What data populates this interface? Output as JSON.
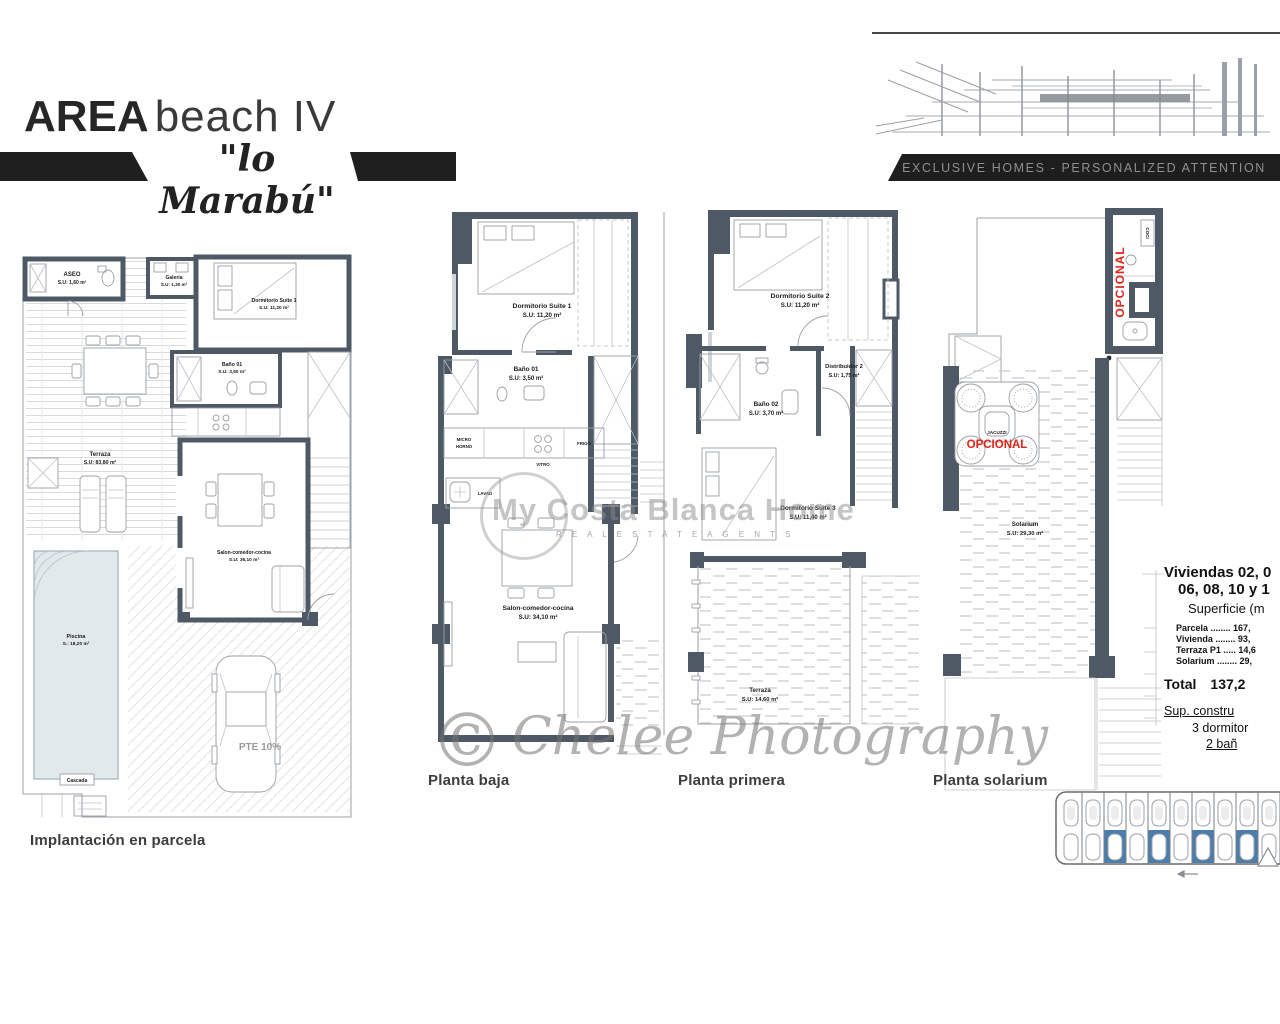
{
  "header": {
    "brand_main": "AREA",
    "brand_sub": "beach IV",
    "brand_script": "\"lo Marabú\"",
    "tagline": "EXCLUSIVE HOMES - PERSONALIZED ATTENTION"
  },
  "watermarks": {
    "center_title": "My Costa Blanca Home",
    "center_sub": "R E A L   E S T A T E   A G E N T S",
    "photo_symbol": "©",
    "photo_text": "Chelee Photography"
  },
  "plans": [
    {
      "caption": "Implantación en parcela",
      "rooms": [
        {
          "name": "ASEO",
          "area": "S.U: 1,60 m²"
        },
        {
          "name": "Galería",
          "area": "S.U: 1,30 m²"
        },
        {
          "name": "Dormitorio Suite 1",
          "area": "S.U: 11,20 m²"
        },
        {
          "name": "Baño 01",
          "area": "S.U: 3,50 m²"
        },
        {
          "name": "Terraza",
          "area": "S.U: 83,80 m²"
        },
        {
          "name": "Salon-comedor-cocina",
          "area": "S.U: 36,10 m²"
        },
        {
          "name": "Piscina",
          "area": "S.: 18,20 m²"
        },
        {
          "name": "Cascada",
          "area": ""
        }
      ],
      "note_pte": "PTE 10%"
    },
    {
      "caption": "Planta baja",
      "rooms": [
        {
          "name": "Dormitorio Suite 1",
          "area": "S.U: 11,20 m²"
        },
        {
          "name": "Baño 01",
          "area": "S.U: 3,50 m²"
        },
        {
          "name": "Salon-comedor-cocina",
          "area": "S.U: 34,10 m²"
        }
      ],
      "appliances": [
        "MICRO",
        "HORNO",
        "VITRO",
        "FRIGO",
        "LAVAD"
      ]
    },
    {
      "caption": "Planta primera",
      "rooms": [
        {
          "name": "Dormitorio Suite 2",
          "area": "S.U: 11,20 m²"
        },
        {
          "name": "Baño 02",
          "area": "S.U: 3,70 m²"
        },
        {
          "name": "Distribuidor 2",
          "area": "S.U: 1,75 m²"
        },
        {
          "name": "Dormitorio Suite 3",
          "area": "S.U: 11,40 m²"
        },
        {
          "name": "Terraza",
          "area": "S.U: 14,60 m²"
        }
      ]
    },
    {
      "caption": "Planta solarium",
      "rooms": [
        {
          "name": "Solarium",
          "area": "S.U: 29,30 m²"
        }
      ],
      "optional_vertical": "OPCIONAL",
      "kitchen_label": "COCI",
      "jacuzzi_label": "JACUZZI",
      "jacuzzi_optional": "OPCIONAL"
    }
  ],
  "info_panel": {
    "title_line1": "Viviendas 02, 0",
    "title_line2": "06, 08, 10 y 1",
    "subtitle": "Superficie (m",
    "surface_rows": [
      {
        "label": "Parcela",
        "dots": " ........ ",
        "value": "167,"
      },
      {
        "label": "Vivienda",
        "dots": " ........ ",
        "value": "93,"
      },
      {
        "label": "Terraza P1",
        "dots": " ..... ",
        "value": "14,6"
      },
      {
        "label": "Solarium",
        "dots": " ........ ",
        "value": "29,"
      }
    ],
    "total_label": "Total",
    "total_value": "137,2",
    "built_label": "Sup. constru",
    "bedrooms": "3 dormitor",
    "bathrooms": "2 bañ"
  },
  "colors": {
    "wall": "#4e5965",
    "accent_red": "#e02318",
    "keyplan_blue": "#4a7dab",
    "pool": "#e2e9ed"
  }
}
